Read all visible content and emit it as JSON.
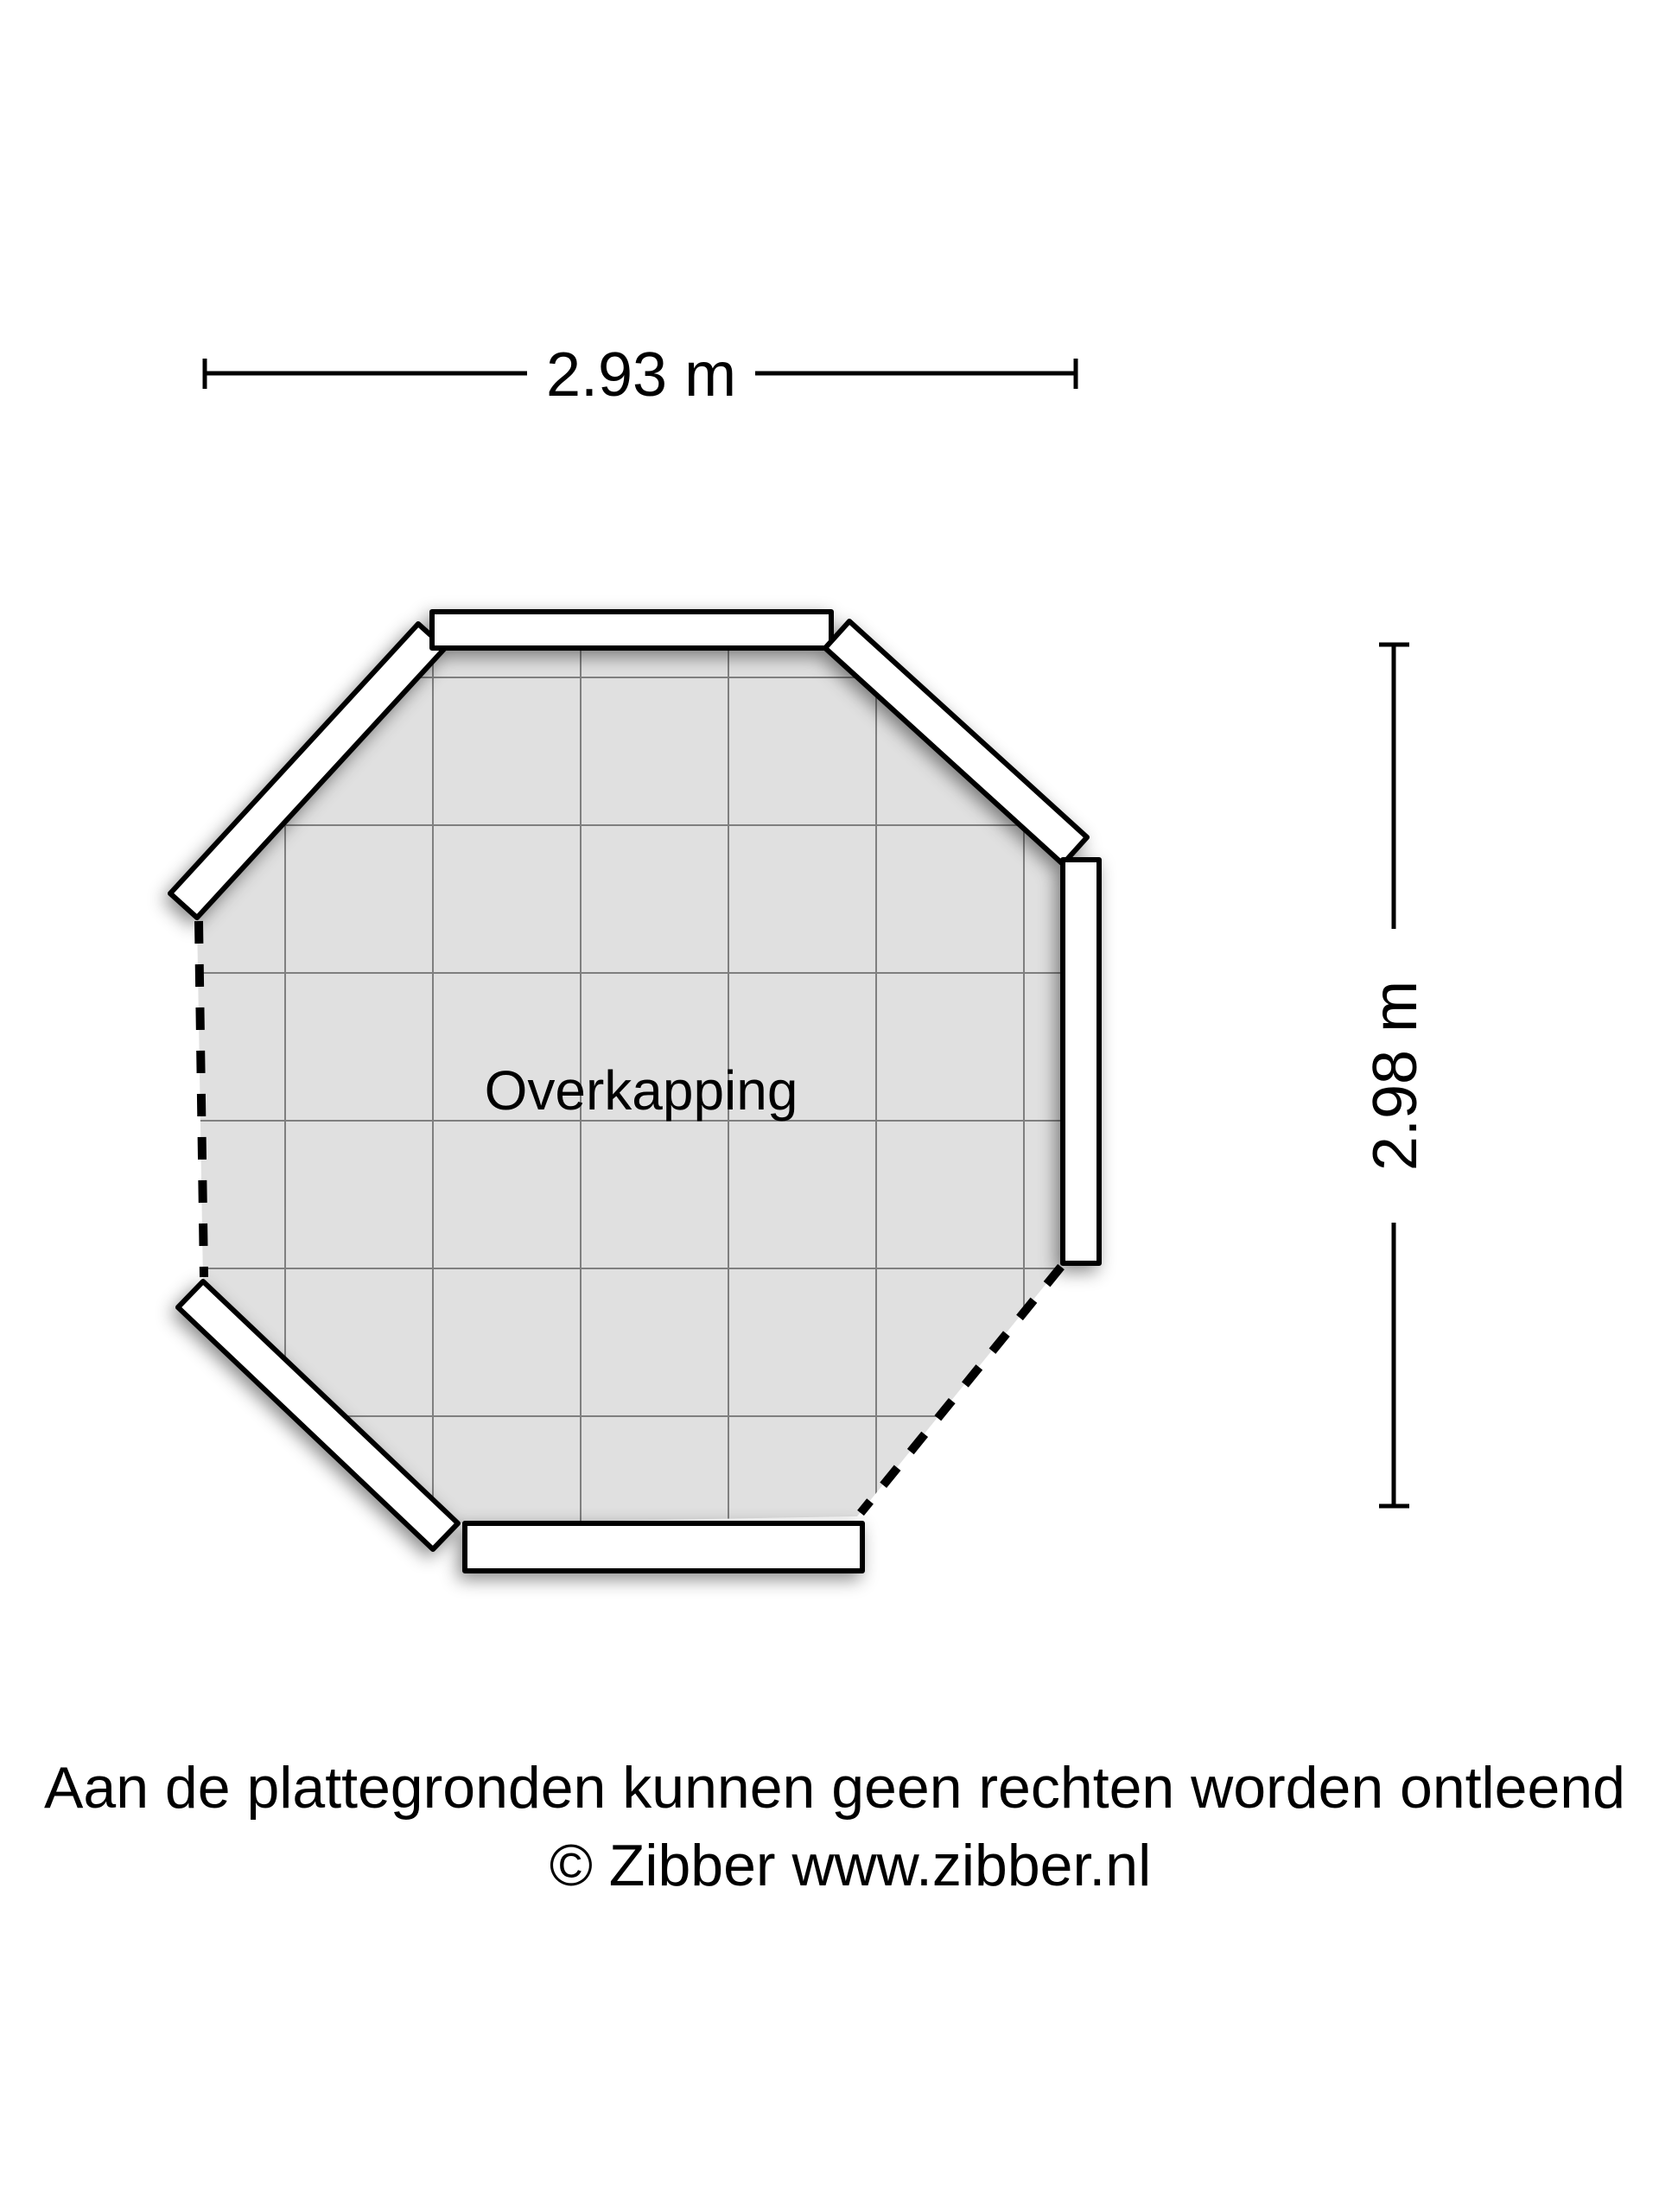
{
  "page": {
    "background_color": "#ffffff"
  },
  "floorplan": {
    "room_label": "Overkapping",
    "floor_color": "#e0e0e0",
    "grid_color": "#6f6f6f",
    "wall_fill": "#ffffff",
    "line_color": "#000000",
    "open_edges": "left and lower-right edges drawn dashed (open sides)"
  },
  "dimensions": {
    "width": {
      "label": "2.93 m"
    },
    "height": {
      "label": "2.98 m"
    }
  },
  "footer": {
    "disclaimer": "Aan de plattegronden kunnen geen rechten worden ontleend",
    "copyright": "© Zibber www.zibber.nl"
  }
}
